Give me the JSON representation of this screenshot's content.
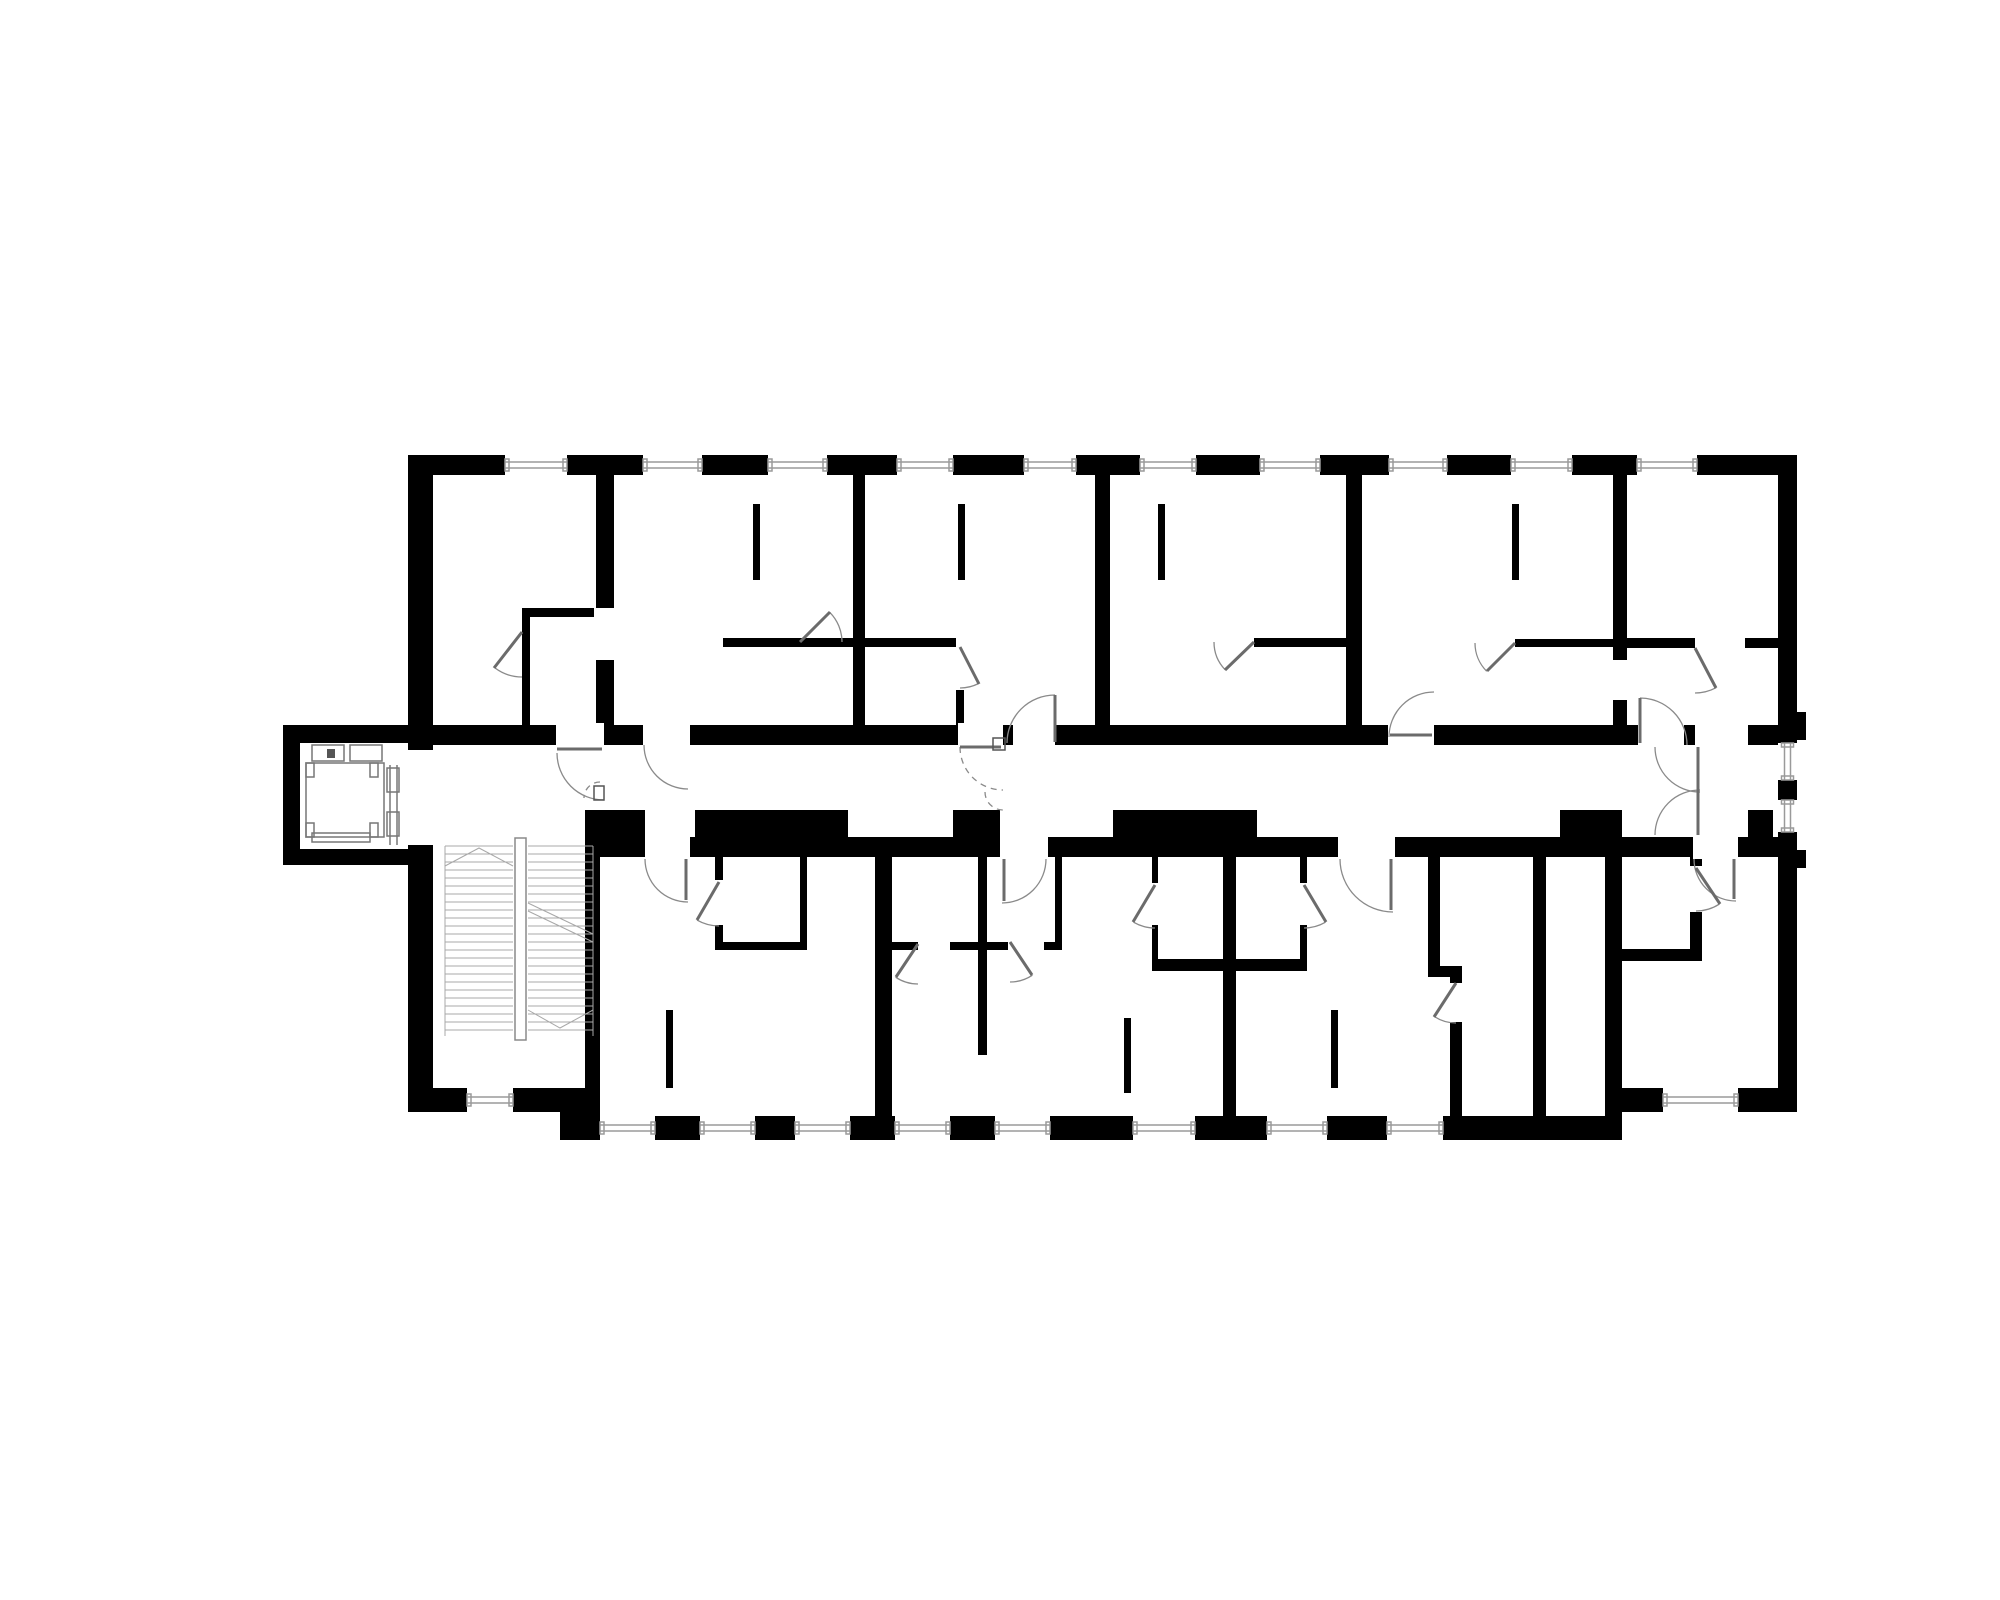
{
  "drawing": {
    "kind": "architectural-floor-plan",
    "canvas": {
      "w": 2000,
      "h": 1600,
      "bg": "#ffffff"
    },
    "colors": {
      "wall": "#000000",
      "door": "#8a8a8a",
      "leaf": "#6b6b6b",
      "window": "#9a9a9a",
      "stair": "#a8a8a8",
      "elevator": "#777777",
      "mark": "#555555"
    },
    "walls": [
      [
        408,
        455,
        1389,
        20
      ],
      [
        408,
        455,
        25,
        657
      ],
      [
        1778,
        455,
        19,
        657
      ],
      [
        560,
        1116,
        1062,
        24
      ],
      [
        408,
        1088,
        189,
        24
      ],
      [
        1605,
        1088,
        192,
        24
      ],
      [
        1605,
        1088,
        17,
        52
      ],
      [
        560,
        1088,
        37,
        28
      ],
      [
        283,
        725,
        125,
        18
      ],
      [
        283,
        725,
        17,
        140
      ],
      [
        283,
        849,
        125,
        16
      ],
      [
        408,
        725,
        1370,
        20
      ],
      [
        597,
        837,
        1181,
        20
      ],
      [
        596,
        810,
        49,
        27
      ],
      [
        695,
        810,
        153,
        27
      ],
      [
        953,
        810,
        47,
        27
      ],
      [
        1113,
        810,
        144,
        27
      ],
      [
        1560,
        810,
        62,
        27
      ],
      [
        1748,
        810,
        25,
        47
      ],
      [
        596,
        475,
        18,
        250
      ],
      [
        853,
        475,
        12,
        250
      ],
      [
        1095,
        475,
        15,
        250
      ],
      [
        1346,
        475,
        16,
        250
      ],
      [
        1613,
        475,
        14,
        250
      ],
      [
        585,
        810,
        15,
        306
      ],
      [
        522,
        608,
        8,
        117
      ],
      [
        522,
        608,
        76,
        9
      ],
      [
        723,
        638,
        130,
        9
      ],
      [
        865,
        638,
        91,
        9
      ],
      [
        956,
        690,
        8,
        35
      ],
      [
        1254,
        638,
        92,
        9
      ],
      [
        1515,
        639,
        98,
        8
      ],
      [
        1627,
        638,
        68,
        10
      ],
      [
        1745,
        638,
        33,
        10
      ],
      [
        753,
        504,
        7,
        76
      ],
      [
        958,
        504,
        7,
        76
      ],
      [
        1158,
        504,
        7,
        76
      ],
      [
        1512,
        504,
        7,
        76
      ],
      [
        875,
        857,
        17,
        259
      ],
      [
        1223,
        857,
        13,
        259
      ],
      [
        1428,
        857,
        12,
        118
      ],
      [
        1428,
        966,
        34,
        11
      ],
      [
        1450,
        977,
        12,
        139
      ],
      [
        1533,
        857,
        13,
        259
      ],
      [
        1605,
        857,
        17,
        231
      ],
      [
        715,
        857,
        8,
        93
      ],
      [
        800,
        857,
        7,
        93
      ],
      [
        715,
        942,
        92,
        8
      ],
      [
        978,
        857,
        9,
        198
      ],
      [
        1055,
        857,
        7,
        93
      ],
      [
        892,
        942,
        170,
        8
      ],
      [
        1152,
        857,
        6,
        108
      ],
      [
        1152,
        959,
        71,
        12
      ],
      [
        1300,
        857,
        7,
        108
      ],
      [
        1236,
        959,
        71,
        12
      ],
      [
        1690,
        857,
        12,
        98
      ],
      [
        1622,
        949,
        80,
        12
      ],
      [
        666,
        1010,
        7,
        78
      ],
      [
        1124,
        1018,
        7,
        75
      ],
      [
        1331,
        1010,
        7,
        78
      ],
      [
        1795,
        712,
        11,
        28
      ],
      [
        1795,
        850,
        11,
        18
      ]
    ],
    "gaps": [
      [
        556,
        723,
        48,
        24
      ],
      [
        643,
        723,
        47,
        24
      ],
      [
        958,
        723,
        45,
        24
      ],
      [
        1013,
        723,
        42,
        24
      ],
      [
        1388,
        723,
        46,
        24
      ],
      [
        1638,
        723,
        46,
        24
      ],
      [
        1695,
        723,
        53,
        24
      ],
      [
        645,
        835,
        45,
        24
      ],
      [
        1000,
        835,
        48,
        24
      ],
      [
        1338,
        835,
        57,
        24
      ],
      [
        1693,
        835,
        45,
        24
      ],
      [
        405,
        750,
        31,
        95
      ],
      [
        594,
        608,
        22,
        52
      ],
      [
        1611,
        660,
        18,
        40
      ],
      [
        1448,
        983,
        16,
        39
      ],
      [
        713,
        880,
        12,
        45
      ],
      [
        1150,
        883,
        10,
        42
      ],
      [
        1298,
        883,
        11,
        42
      ],
      [
        1688,
        866,
        16,
        46
      ],
      [
        918,
        940,
        32,
        12
      ],
      [
        1008,
        940,
        36,
        12
      ]
    ],
    "windows_h": [
      [
        505,
        455,
        62,
        20
      ],
      [
        643,
        455,
        59,
        20
      ],
      [
        768,
        455,
        59,
        20
      ],
      [
        897,
        455,
        56,
        20
      ],
      [
        1024,
        455,
        52,
        20
      ],
      [
        1140,
        455,
        56,
        20
      ],
      [
        1260,
        455,
        60,
        20
      ],
      [
        1389,
        455,
        58,
        20
      ],
      [
        1511,
        455,
        61,
        20
      ],
      [
        1637,
        455,
        60,
        20
      ],
      [
        600,
        1116,
        55,
        24
      ],
      [
        700,
        1116,
        55,
        24
      ],
      [
        795,
        1116,
        55,
        24
      ],
      [
        895,
        1116,
        55,
        24
      ],
      [
        995,
        1116,
        55,
        24
      ],
      [
        1133,
        1116,
        62,
        24
      ],
      [
        1267,
        1116,
        60,
        24
      ],
      [
        1387,
        1116,
        56,
        24
      ],
      [
        1663,
        1088,
        75,
        24
      ],
      [
        467,
        1088,
        46,
        24
      ]
    ],
    "windows_v": [
      [
        1778,
        743,
        19,
        37
      ],
      [
        1778,
        800,
        19,
        32
      ]
    ],
    "arcs": [
      {
        "c": [
          604,
          753
        ],
        "r": 47,
        "a0": 180,
        "a1": 90,
        "dashed": false
      },
      {
        "c": [
          600,
          798
        ],
        "r": 16,
        "a0": 270,
        "a1": 180,
        "dashed": true
      },
      {
        "c": [
          688,
          745
        ],
        "r": 44,
        "a0": 180,
        "a1": 90,
        "dashed": false
      },
      {
        "c": [
          1003,
          747
        ],
        "r": 43,
        "a0": 180,
        "a1": 90,
        "dashed": true
      },
      {
        "c": [
          1003,
          792
        ],
        "r": 18,
        "a0": 180,
        "a1": 90,
        "dashed": true
      },
      {
        "c": [
          1055,
          743
        ],
        "r": 48,
        "a0": 270,
        "a1": 180,
        "dashed": false
      },
      {
        "c": [
          1434,
          737
        ],
        "r": 45,
        "a0": 180,
        "a1": 270,
        "dashed": false
      },
      {
        "c": [
          1640,
          745
        ],
        "r": 47,
        "a0": 270,
        "a1": 360,
        "dashed": false
      },
      {
        "c": [
          1700,
          747
        ],
        "r": 45,
        "a0": 180,
        "a1": 90,
        "dashed": false
      },
      {
        "c": [
          1700,
          835
        ],
        "r": 45,
        "a0": 180,
        "a1": 270,
        "dashed": false
      },
      {
        "c": [
          688,
          859
        ],
        "r": 43,
        "a0": 180,
        "a1": 90,
        "dashed": false
      },
      {
        "c": [
          1002,
          859
        ],
        "r": 44,
        "a0": 0,
        "a1": 90,
        "dashed": false
      },
      {
        "c": [
          1393,
          859
        ],
        "r": 53,
        "a0": 180,
        "a1": 90,
        "dashed": false
      },
      {
        "c": [
          1736,
          859
        ],
        "r": 42,
        "a0": 180,
        "a1": 90,
        "dashed": false
      },
      {
        "c": [
          522,
          632
        ],
        "r": 45,
        "a0": 127,
        "a1": 90,
        "dashed": false
      },
      {
        "c": [
          800,
          642
        ],
        "r": 42,
        "a0": 315,
        "a1": 0,
        "dashed": false
      },
      {
        "c": [
          960,
          647
        ],
        "r": 41,
        "a0": 63,
        "a1": 90,
        "dashed": false
      },
      {
        "c": [
          1254,
          642
        ],
        "r": 40,
        "a0": 136,
        "a1": 180,
        "dashed": false
      },
      {
        "c": [
          1515,
          643
        ],
        "r": 40,
        "a0": 135,
        "a1": 180,
        "dashed": false
      },
      {
        "c": [
          1695,
          648
        ],
        "r": 45,
        "a0": 62,
        "a1": 90,
        "dashed": false
      },
      {
        "c": [
          719,
          882
        ],
        "r": 44,
        "a0": 120,
        "a1": 90,
        "dashed": false
      },
      {
        "c": [
          1155,
          885
        ],
        "r": 43,
        "a0": 120,
        "a1": 90,
        "dashed": false
      },
      {
        "c": [
          1304,
          885
        ],
        "r": 43,
        "a0": 60,
        "a1": 90,
        "dashed": false
      },
      {
        "c": [
          1696,
          868
        ],
        "r": 43,
        "a0": 57,
        "a1": 90,
        "dashed": false
      },
      {
        "c": [
          1456,
          983
        ],
        "r": 40,
        "a0": 123,
        "a1": 90,
        "dashed": false
      },
      {
        "c": [
          918,
          944
        ],
        "r": 40,
        "a0": 124,
        "a1": 90,
        "dashed": false
      },
      {
        "c": [
          1010,
          942
        ],
        "r": 40,
        "a0": 56,
        "a1": 90,
        "dashed": false
      }
    ],
    "leaves": [
      [
        557,
        749,
        602,
        749
      ],
      [
        960,
        747,
        1001,
        747
      ],
      [
        1390,
        735,
        1432,
        735
      ],
      [
        1698,
        747,
        1698,
        791
      ],
      [
        1698,
        791,
        1698,
        835
      ],
      [
        686,
        859,
        686,
        900
      ],
      [
        1004,
        859,
        1004,
        901
      ],
      [
        1391,
        859,
        1391,
        910
      ],
      [
        1734,
        859,
        1734,
        899
      ],
      [
        1055,
        695,
        1055,
        742
      ],
      [
        1640,
        698,
        1640,
        743
      ],
      [
        522,
        632,
        494,
        668
      ],
      [
        800,
        642,
        830,
        612
      ],
      [
        960,
        647,
        979,
        684
      ],
      [
        1254,
        642,
        1225,
        670
      ],
      [
        1515,
        643,
        1487,
        671
      ],
      [
        1695,
        648,
        1716,
        688
      ],
      [
        719,
        882,
        697,
        920
      ],
      [
        1155,
        885,
        1133,
        922
      ],
      [
        1304,
        885,
        1326,
        922
      ],
      [
        1696,
        868,
        1720,
        904
      ],
      [
        1456,
        983,
        1434,
        1017
      ],
      [
        918,
        944,
        896,
        977
      ],
      [
        1010,
        942,
        1032,
        975
      ]
    ],
    "marks": [
      [
        993,
        738,
        12,
        12
      ],
      [
        594,
        786,
        10,
        14
      ]
    ],
    "stairs": {
      "x_left": 445,
      "x_mid1": 513,
      "x_mid2": 528,
      "x_right": 593,
      "y_top": 846,
      "y_bot": 1036,
      "step": 8,
      "rail": [
        515,
        838,
        11,
        202
      ],
      "chevron_left": [
        445,
        866,
        479,
        848,
        513,
        866
      ],
      "chevron_right": [
        528,
        1010,
        560,
        1028,
        593,
        1010
      ],
      "breaks": [
        [
          528,
          903,
          593,
          934
        ],
        [
          528,
          911,
          593,
          942
        ]
      ]
    },
    "elevator": {
      "car": [
        306,
        763,
        78,
        74
      ],
      "mech": [
        [
          312,
          745,
          32,
          16
        ],
        [
          350,
          745,
          32,
          16
        ]
      ],
      "mech_mark": [
        327,
        749,
        8,
        9
      ],
      "corners": [
        [
          306,
          763,
          8,
          14
        ],
        [
          370,
          763,
          8,
          14
        ],
        [
          306,
          823,
          8,
          14
        ],
        [
          370,
          823,
          8,
          14
        ]
      ],
      "bottom": [
        312,
        833,
        58,
        9
      ],
      "door_lines": [
        [
          390,
          765,
          390,
          845
        ],
        [
          397,
          765,
          397,
          845
        ]
      ],
      "door_boxes": [
        [
          387,
          768,
          12,
          24
        ],
        [
          387,
          812,
          12,
          24
        ]
      ]
    }
  }
}
